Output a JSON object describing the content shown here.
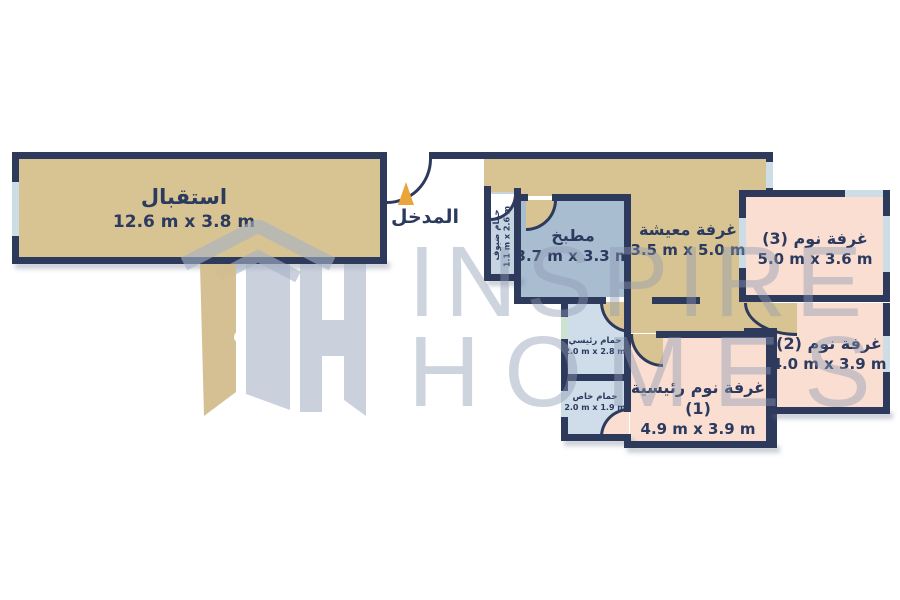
{
  "brand": {
    "watermark_line1": "INSPIRE",
    "watermark_line2": "HOMES"
  },
  "entrance": {
    "label": "المدخل"
  },
  "rooms": {
    "reception": {
      "name": "استقبال",
      "dims": "12.6 m x 3.8 m"
    },
    "kitchen": {
      "name": "مطبخ",
      "dims": "3.7 m x 3.3 m"
    },
    "living": {
      "name": "غرفة معيشة",
      "dims": "3.5 m x 5.0 m"
    },
    "bedroom3": {
      "name": "غرفة نوم (3)",
      "dims": "5.0 m x 3.6 m"
    },
    "bedroom2": {
      "name": "غرفة نوم (2)",
      "dims": "4.0 m x 3.9 m"
    },
    "master_bedroom": {
      "name": "غرفة نوم رئيسية (1)",
      "dims": "4.9 m x 3.9 m"
    },
    "master_bath": {
      "name": "حمام رئيسي",
      "dims": "2.0 m x 2.8 m"
    },
    "private_bath": {
      "name": "حمام خاص",
      "dims": "2.0 m x 1.9 m"
    },
    "guest_bath": {
      "name": "حمام ضيوف",
      "dims": "1.1 m x 2.6 m"
    }
  },
  "colors": {
    "wall": "#2e3a5c",
    "ink": "#2b3a5e",
    "tan": "#d8c492",
    "kitchen": "#a9bdd1",
    "bath": "#cfdcea",
    "guestbath": "#c6d4e2",
    "bedroom": "#f9ded1",
    "window": "#cddde5",
    "windowgreen": "#cde3d2",
    "arrow": "#e9a43c",
    "watermark": "#8d9ab3"
  }
}
